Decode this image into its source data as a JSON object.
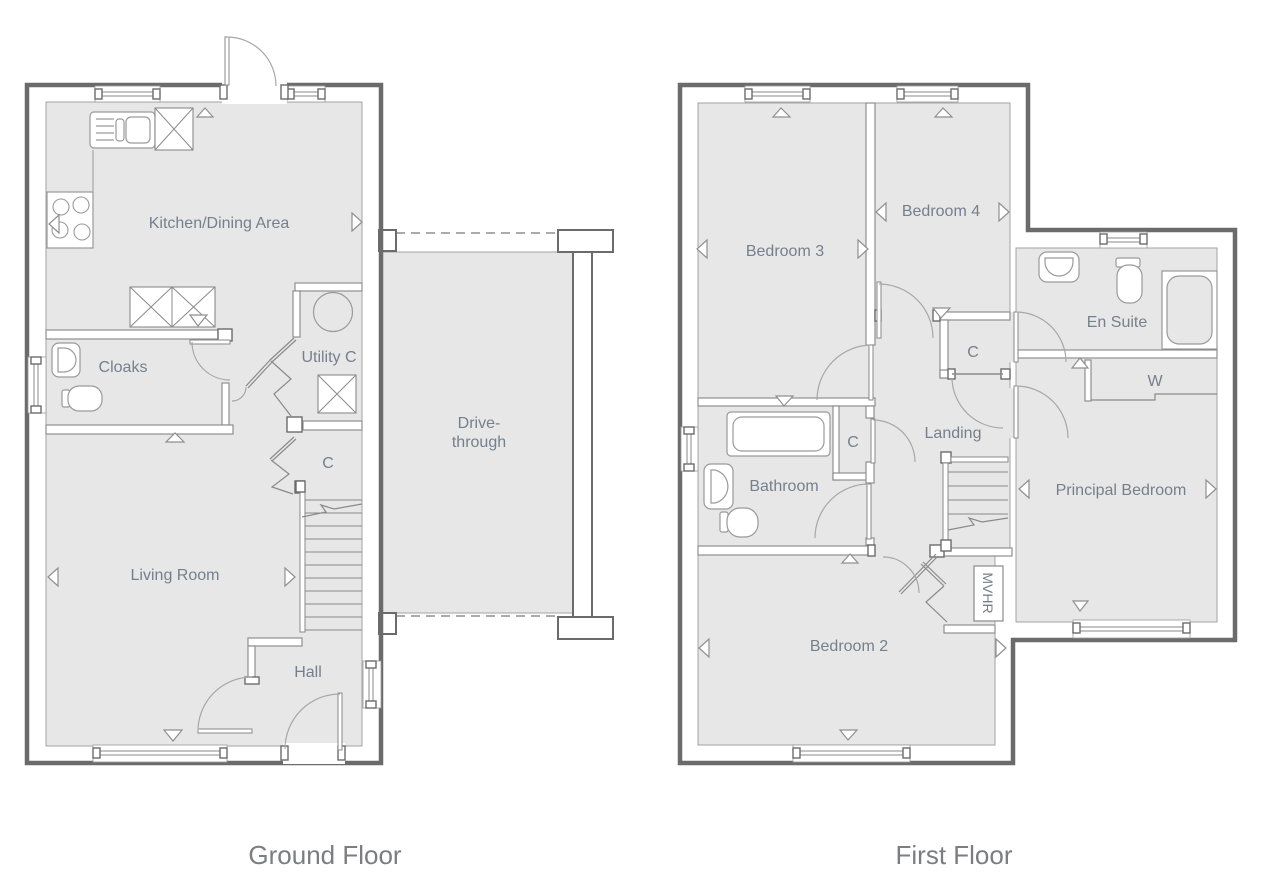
{
  "ground_floor": {
    "caption": "Ground Floor",
    "rooms": {
      "kitchen": "Kitchen/Dining Area",
      "cloaks": "Cloaks",
      "utility": "Utility C",
      "cupboard": "C",
      "living": "Living Room",
      "hall": "Hall",
      "drive_line1": "Drive-",
      "drive_line2": "through"
    }
  },
  "first_floor": {
    "caption": "First Floor",
    "rooms": {
      "bedroom3": "Bedroom 3",
      "bedroom4": "Bedroom 4",
      "cupboard_top": "C",
      "ensuite": "En Suite",
      "wardrobe": "W",
      "landing": "Landing",
      "bathroom": "Bathroom",
      "cupboard_mid": "C",
      "principal": "Principal Bedroom",
      "bedroom2": "Bedroom 2",
      "mvhr": "MVHR"
    }
  },
  "colors": {
    "exterior_wall": "#6b6b6b",
    "partition_line": "#8f8f8f",
    "fixture_line": "#9a9a9a",
    "floor_fill": "#e7e7e7",
    "room_label": "#75808d",
    "caption_text": "#7b7d80"
  }
}
